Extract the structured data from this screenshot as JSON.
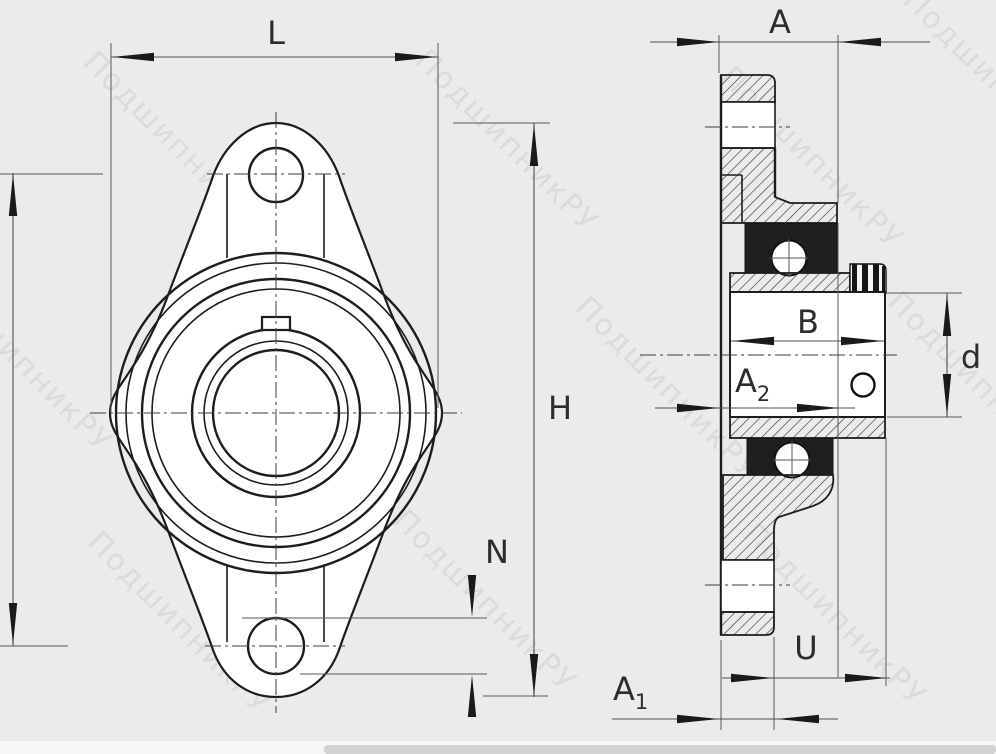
{
  "page": {
    "background_color": "#ebebeb"
  },
  "drawing": {
    "line_color": "#1d1d1d",
    "dimension_color": "#4f4f4f",
    "labels": {
      "l": "L",
      "a": "A",
      "h": "H",
      "n": "N",
      "b": "B",
      "u": "U",
      "d": "d",
      "a1": {
        "base": "A",
        "sub": "1"
      },
      "a2": {
        "base": "A",
        "sub": "2"
      }
    }
  },
  "watermark": {
    "text": "ПодшипникРУ"
  }
}
